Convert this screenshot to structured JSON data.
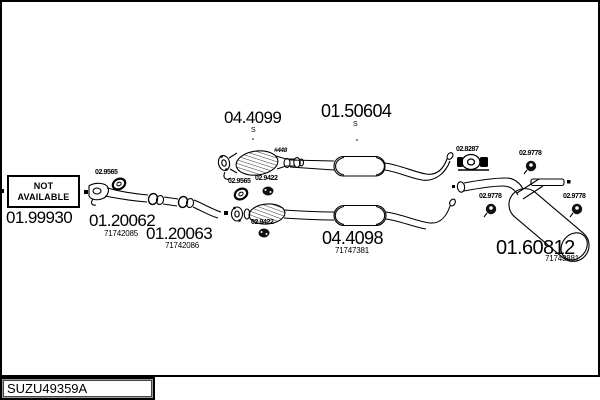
{
  "plate": {
    "code": "SUZU49359A"
  },
  "not_available": {
    "line1": "NOT",
    "line2": "AVAILABLE"
  },
  "parts": [
    {
      "code": "01.99930"
    },
    {
      "code": "01.20062",
      "ref": "71742085"
    },
    {
      "code": "01.20063",
      "ref": "71742086"
    },
    {
      "code": "04.4099",
      "sub": "S"
    },
    {
      "code": "01.50604",
      "sub": "S"
    },
    {
      "code": "04.4098",
      "ref": "71747381"
    },
    {
      "code": "01.60812",
      "ref": "71743881"
    }
  ],
  "fittings": [
    "02.9565",
    "02.9565",
    "02.9422",
    "02.9422",
    "02.8287",
    "02.9778",
    "02.9778",
    "02.9778"
  ],
  "annotations": {
    "pipe_marking": "#448"
  }
}
